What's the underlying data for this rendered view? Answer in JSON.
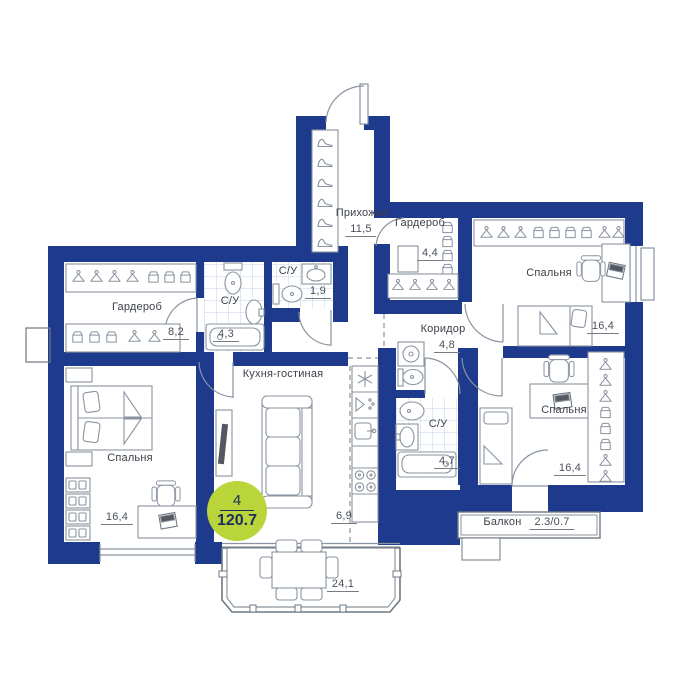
{
  "plan": {
    "badge": {
      "rooms": "4",
      "total_area": "120.7"
    },
    "rooms": {
      "hallway": {
        "name": "Прихожая",
        "area": "11,5"
      },
      "wardrobe_entry": {
        "name": "Гардероб",
        "area": "4,4"
      },
      "bedroom_top_right": {
        "name": "Спальня",
        "area": "16,4"
      },
      "corridor": {
        "name": "Коридор",
        "area": "4,8"
      },
      "bathroom_main": {
        "name": "С/У",
        "area": "4,7"
      },
      "bedroom_bottom_right": {
        "name": "Спальня",
        "area": "16,4"
      },
      "balcony": {
        "name": "Балкон",
        "area": "2.3/0.7"
      },
      "wardrobe_left": {
        "name": "Гардероб",
        "area": "8,2"
      },
      "bathroom_left": {
        "name": "С/У",
        "area": "4,3"
      },
      "bathroom_small": {
        "name": "С/У",
        "area": "1,9"
      },
      "kitchen_living": {
        "name": "Кухня-гостиная",
        "area": "24,1",
        "kitchen_zone_area": "6,9"
      },
      "bedroom_bottom_left": {
        "name": "Спальня",
        "area": "16,4"
      }
    },
    "colors": {
      "wall": "#1d3a8c",
      "tile": "#c4d2e8",
      "badge": "#b9d53a",
      "furniture_line": "#8a93a0",
      "text": "#3c4148"
    }
  }
}
